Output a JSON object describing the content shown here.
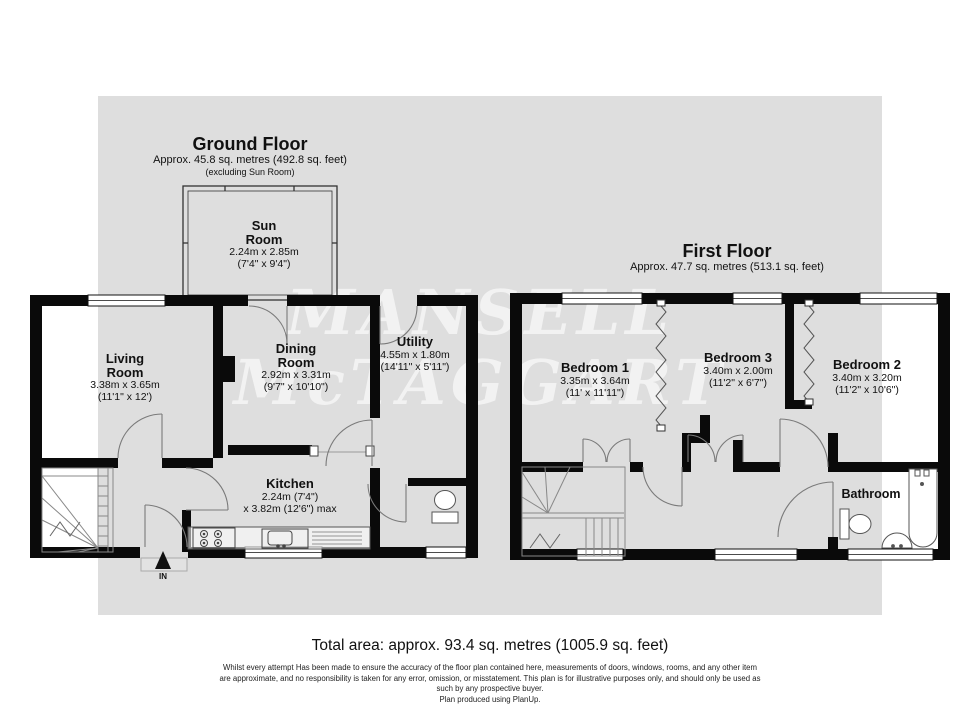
{
  "watermark": {
    "line1": "MANSELL",
    "line2": "McTAGGART"
  },
  "colors": {
    "canvas": "#dedede",
    "wall": "#0a0a0a",
    "thin_line": "#777777"
  },
  "ground_floor": {
    "title": "Ground Floor",
    "subtitle": "Approx. 45.8 sq. metres (492.8 sq. feet)",
    "note": "(excluding Sun Room)",
    "entry_label": "IN",
    "rooms": {
      "sun": {
        "name": "Sun Room",
        "dim_m": "2.24m x 2.85m",
        "dim_ft": "(7'4\" x 9'4\")"
      },
      "living": {
        "name": "Living Room",
        "dim_m": "3.38m x 3.65m",
        "dim_ft": "(11'1\" x 12')"
      },
      "dining": {
        "name": "Dining Room",
        "dim_m": "2.92m x 3.31m",
        "dim_ft": "(9'7\" x 10'10\")"
      },
      "utility": {
        "name": "Utility",
        "dim_m": "4.55m x 1.80m",
        "dim_ft": "(14'11\" x 5'11\")"
      },
      "kitchen": {
        "name": "Kitchen",
        "dim_m": "2.24m (7'4\")",
        "dim_ft": "x 3.82m (12'6\") max"
      }
    }
  },
  "first_floor": {
    "title": "First Floor",
    "subtitle": "Approx. 47.7 sq. metres (513.1 sq. feet)",
    "rooms": {
      "bed1": {
        "name": "Bedroom 1",
        "dim_m": "3.35m x 3.64m",
        "dim_ft": "(11' x 11'11\")"
      },
      "bed3": {
        "name": "Bedroom 3",
        "dim_m": "3.40m x 2.00m",
        "dim_ft": "(11'2\" x 6'7\")"
      },
      "bed2": {
        "name": "Bedroom 2",
        "dim_m": "3.40m x 3.20m",
        "dim_ft": "(11'2\" x 10'6\")"
      },
      "bathroom": {
        "name": "Bathroom"
      }
    }
  },
  "footer": {
    "total_area": "Total area: approx. 93.4 sq. metres (1005.9 sq. feet)",
    "disclaimer_lines": [
      "Whilst every attempt Has been made to ensure the accuracy of the floor plan contained here, measurements of doors, windows, rooms, and any other item",
      "are approximate, and no responsibility is taken for any error, omission, or misstatement. This plan is for illustrative purposes only, and should only be used as",
      "such by any prospective buyer.",
      "Plan produced using PlanUp."
    ]
  }
}
